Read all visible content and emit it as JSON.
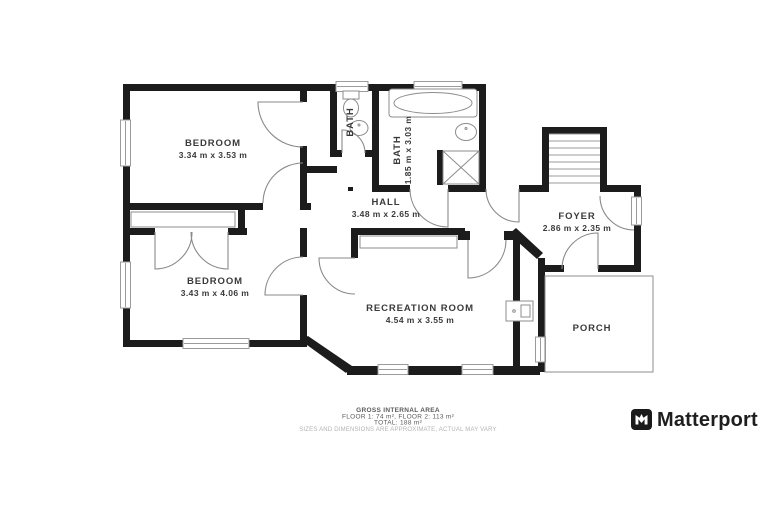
{
  "rooms": {
    "bedroom1": {
      "name": "BEDROOM",
      "dims": "3.34 m x 3.53 m"
    },
    "bedroom2": {
      "name": "BEDROOM",
      "dims": "3.43 m x 4.06 m"
    },
    "bath1": {
      "name": "BATH"
    },
    "bath2": {
      "name": "BATH",
      "dims": "1.85 m x 3.03 m"
    },
    "hall": {
      "name": "HALL",
      "dims": "3.48 m x 2.65 m"
    },
    "foyer": {
      "name": "FOYER",
      "dims": "2.86 m x 2.35 m"
    },
    "recreation": {
      "name": "RECREATION ROOM",
      "dims": "4.54 m x 3.55 m"
    },
    "porch": {
      "name": "PORCH"
    }
  },
  "footer": {
    "area_title": "GROSS INTERNAL AREA",
    "floors": "FLOOR 1: 74 m², FLOOR 2: 113 m²",
    "total": "TOTAL: 188 m²",
    "disclaimer": "SIZES AND DIMENSIONS ARE APPROXIMATE, ACTUAL MAY VARY"
  },
  "branding": {
    "logo_text": "Matterport"
  },
  "colors": {
    "wall": "#1c1c1c",
    "fixture_line": "#8c8c8c",
    "label_text": "#3a3a3a",
    "disclaimer_text": "#b3b3b3",
    "logo": "#1a1a1a"
  }
}
